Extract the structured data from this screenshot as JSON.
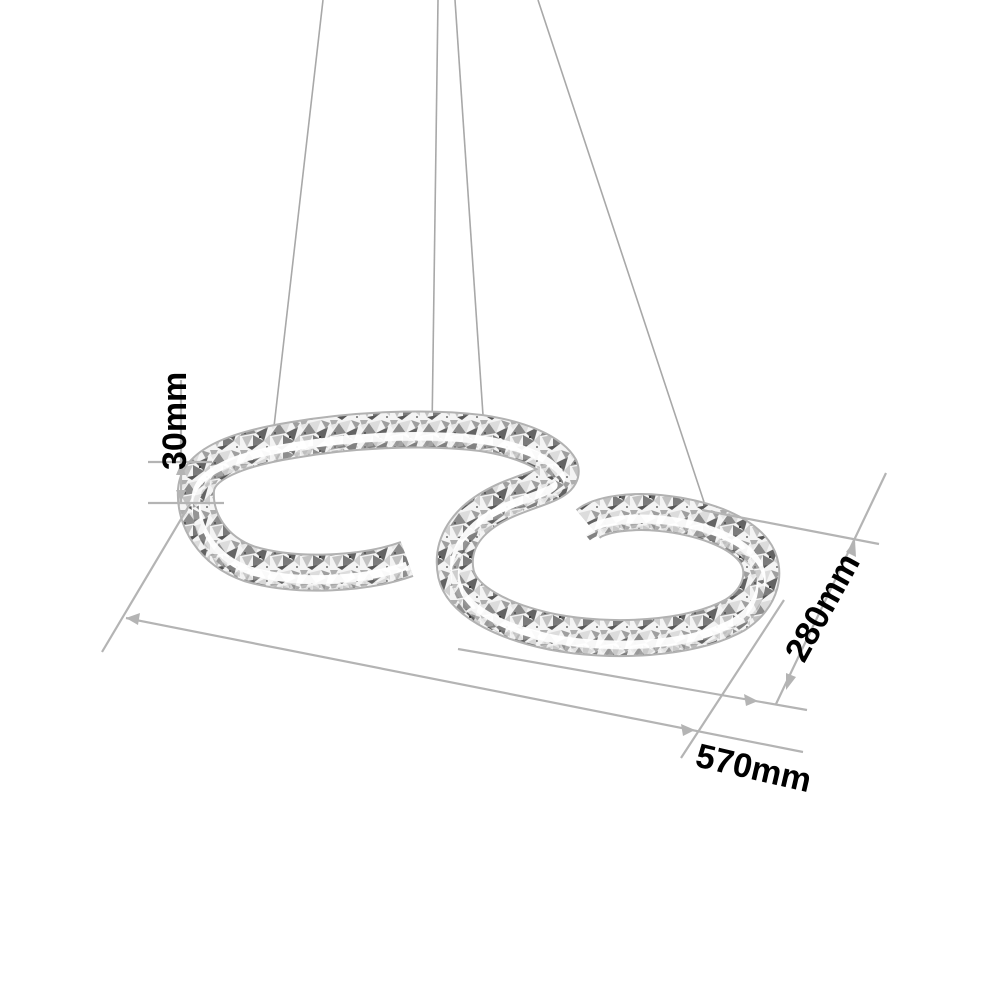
{
  "scene": {
    "subject": "crystal-s-shaped-led-pendant-lamp-dimension-diagram",
    "background": "#ffffff",
    "wire_count": 4
  },
  "colors": {
    "dimension_line": "#b4b4b4",
    "wire": "#a8a8a8",
    "label_text": "#000000"
  },
  "dimensions": {
    "band_height": "30mm",
    "fixture_depth": "280mm",
    "fixture_width": "570mm"
  }
}
